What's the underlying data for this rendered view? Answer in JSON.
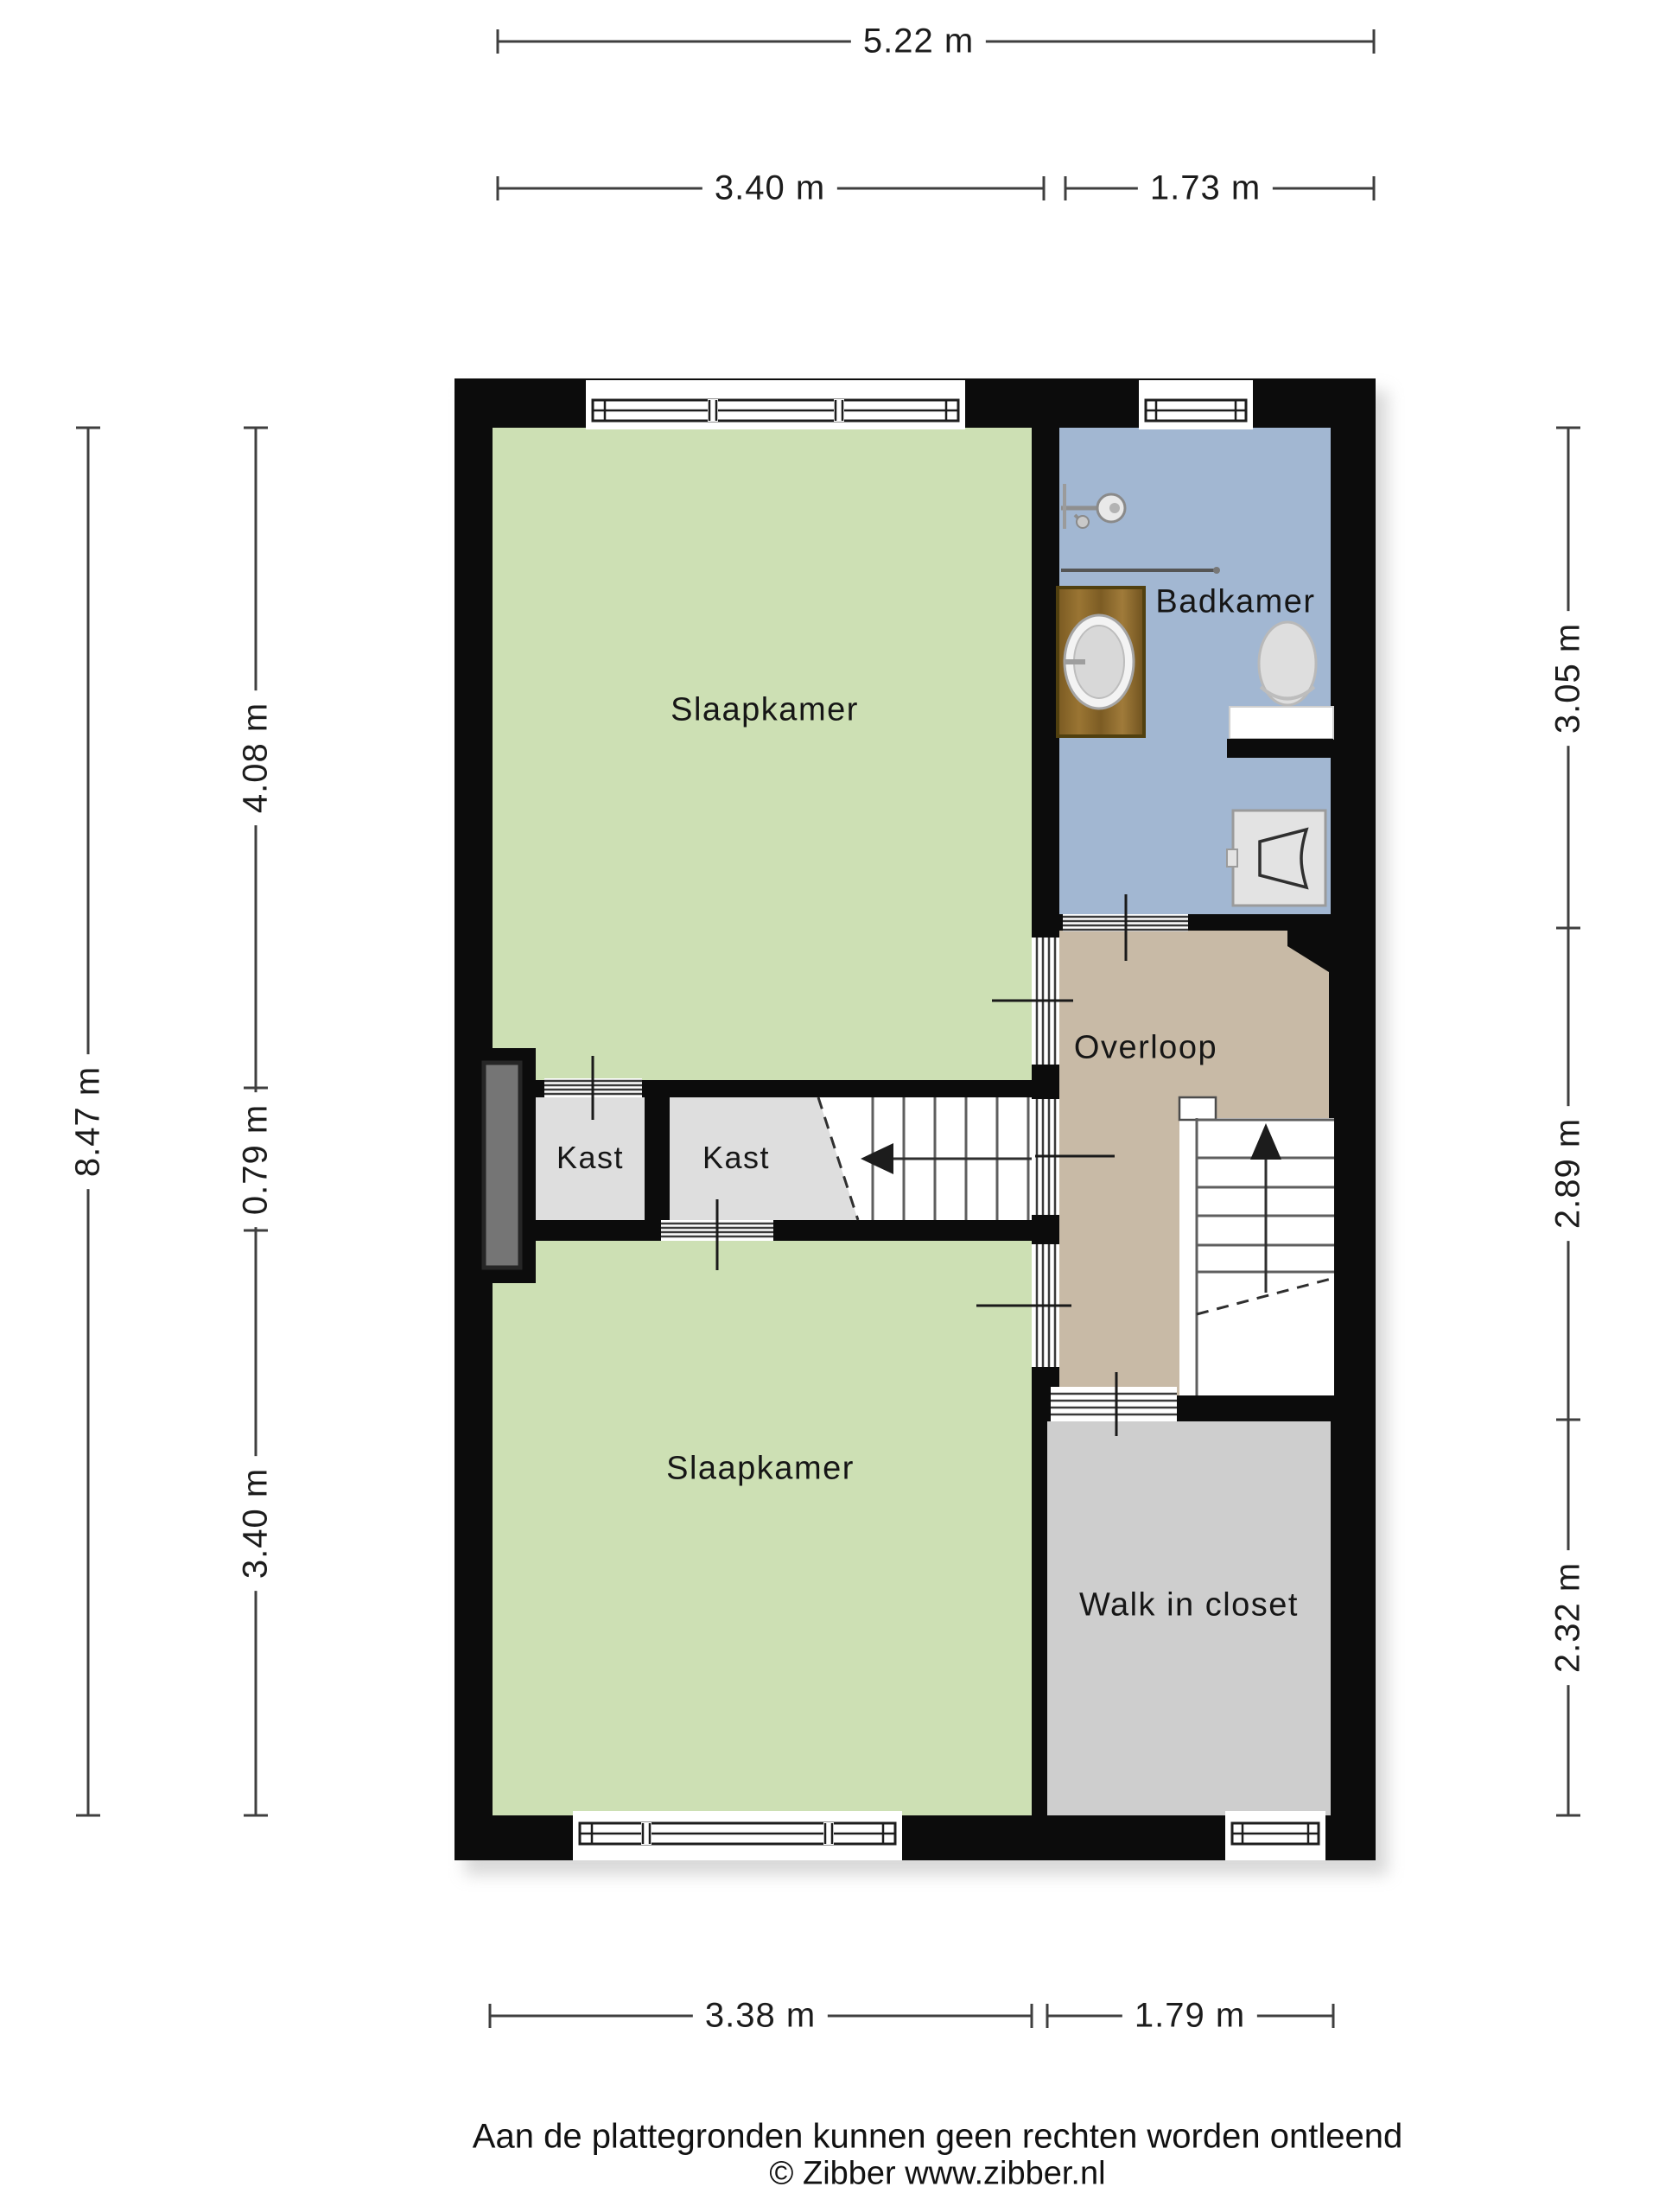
{
  "rooms": {
    "bedroom_top": "Slaapkamer",
    "bathroom": "Badkamer",
    "landing": "Overloop",
    "closet_a": "Kast",
    "closet_b": "Kast",
    "bedroom_bottom": "Slaapkamer",
    "walk_in_closet": "Walk in closet"
  },
  "dimensions": {
    "top_total": "5.22 m",
    "top_left": "3.40 m",
    "top_right": "1.73 m",
    "left_total": "8.47 m",
    "left_seg1": "4.08 m",
    "left_seg2": "0.79 m",
    "left_seg3": "3.40 m",
    "right_seg1": "3.05 m",
    "right_seg2": "2.89 m",
    "right_seg3": "2.32 m",
    "bottom_left": "3.38 m",
    "bottom_right": "1.79 m"
  },
  "footer": {
    "disclaimer": "Aan de plattegronden kunnen geen rechten worden ontleend",
    "copyright": "© Zibber www.zibber.nl"
  },
  "colors": {
    "wall": "#0c0c0c",
    "bedroom": "#cde0b4",
    "bathroom": "#a2b7d2",
    "landing": "#c8baa6",
    "kast": "#dedede",
    "closet": "#cecece",
    "dim": "#3f3f3f",
    "ink": "#1b1b1b"
  }
}
